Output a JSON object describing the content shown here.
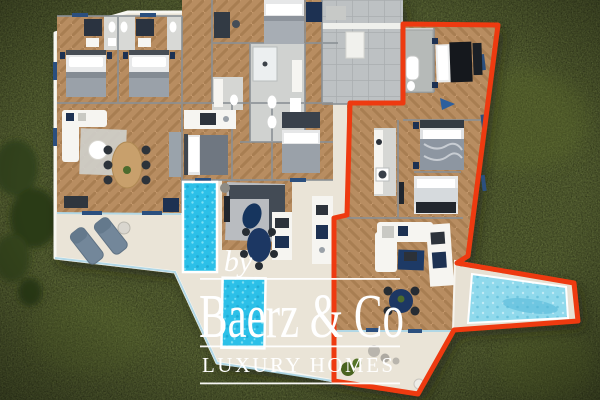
{
  "watermark": {
    "by": "by",
    "brand": "Baerz & Co",
    "tagline": "LUXURY HOMES"
  },
  "palette": {
    "grass": "#4d5a24",
    "terrace": "#eae4d7",
    "wood": "#b88d61",
    "water": "#2cc0e8",
    "water_light": "#8fd9ec",
    "unit_outline": "#ee3a10",
    "courtyard": "#bdc1c3",
    "wall": "#8a9095",
    "watermark_text": "#ffffff"
  },
  "scene": {
    "type": "3d-floor-plan-render",
    "note": "Top view of a villa on a lawn; right-hand apartment outlined in red; three swimming pools; furnished bedrooms, living rooms and terraces."
  }
}
